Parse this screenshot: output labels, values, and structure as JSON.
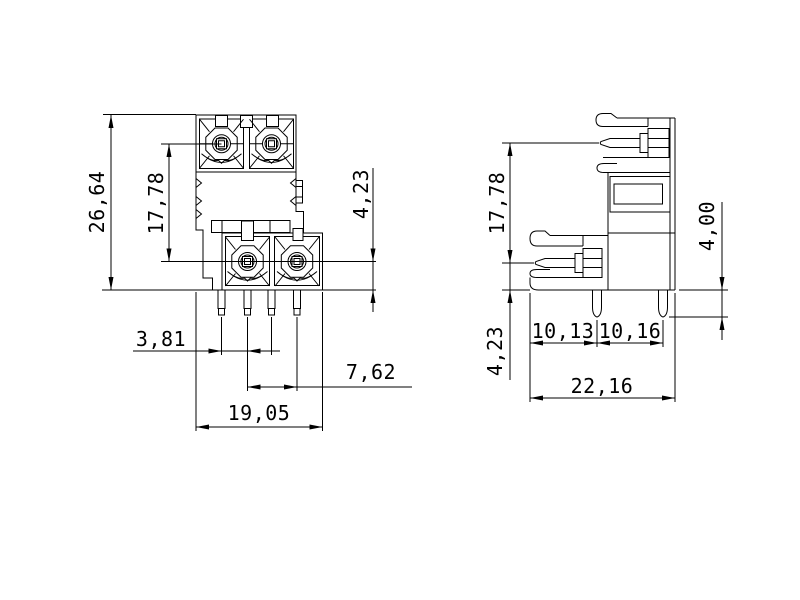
{
  "drawing": {
    "type": "technical-dimension-drawing",
    "subject": "2-level PCB terminal block connector, front and side views",
    "colors": {
      "line": "#000000",
      "background": "#ffffff"
    },
    "front_view": {
      "overall_height": "26,64",
      "screw_row_spacing": "17,78",
      "screw_to_base": "4,23",
      "pin_row_offset": "3,81",
      "pin_pitch": "7,62",
      "overall_width": "19,05"
    },
    "side_view": {
      "screw_row_spacing": "17,78",
      "base_to_lower_screw": "4,23",
      "pin_length": "4,00",
      "edge_to_first_pin": "10,13",
      "pin_to_pin": "10,16",
      "overall_depth": "22,16"
    }
  }
}
